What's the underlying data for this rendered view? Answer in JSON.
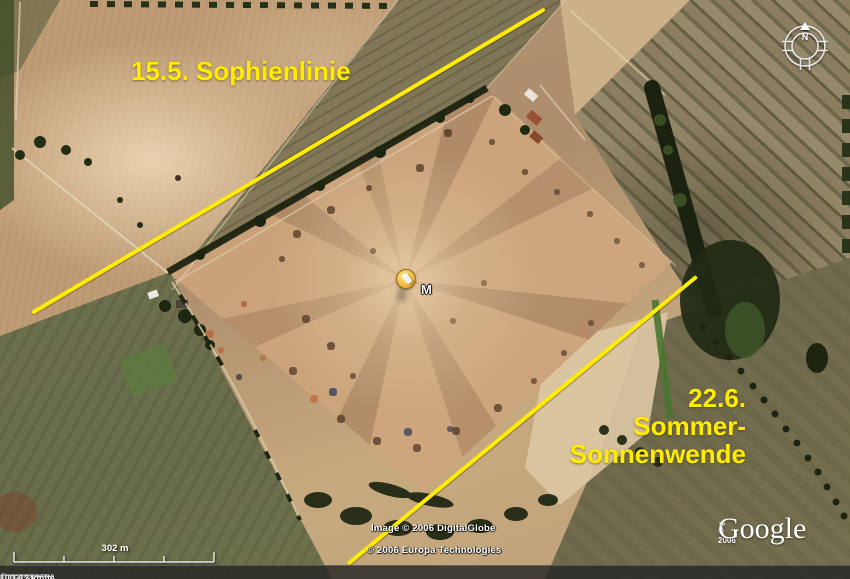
{
  "app": "Google Earth map view",
  "annotations": {
    "accent_color": "#ffec00",
    "sophienlinie_label": "15.5. Sophienlinie",
    "solstice_date": "22.6.",
    "solstice_word1": "Sommer-",
    "solstice_word2": "Sonnenwende"
  },
  "marker": {
    "label": "M"
  },
  "compass": {
    "north": "N"
  },
  "scale_bar": {
    "label": "302 m"
  },
  "copyright": {
    "image_line": "Image © 2006 DigitalGlobe",
    "europa_line": "© 2006 Europa Technologies",
    "google_prefix": "© 2006",
    "google_logo": "Google",
    "google_tm": "™"
  },
  "status_bar": {
    "pointer_label": "Zeiger",
    "lat": "51°06'25.38\"",
    "lat_hem": "N",
    "lon": "1°39'37.05\"",
    "lon_hem": "W",
    "elevation_label": "Höhe",
    "elevation_value": "111 m",
    "streaming_label": "Übertragung",
    "streaming_bars": "||||||||||",
    "streaming_percent": "100%",
    "eye_alt_label": "Sichthöhe",
    "eye_alt_value": "1,13 km"
  }
}
